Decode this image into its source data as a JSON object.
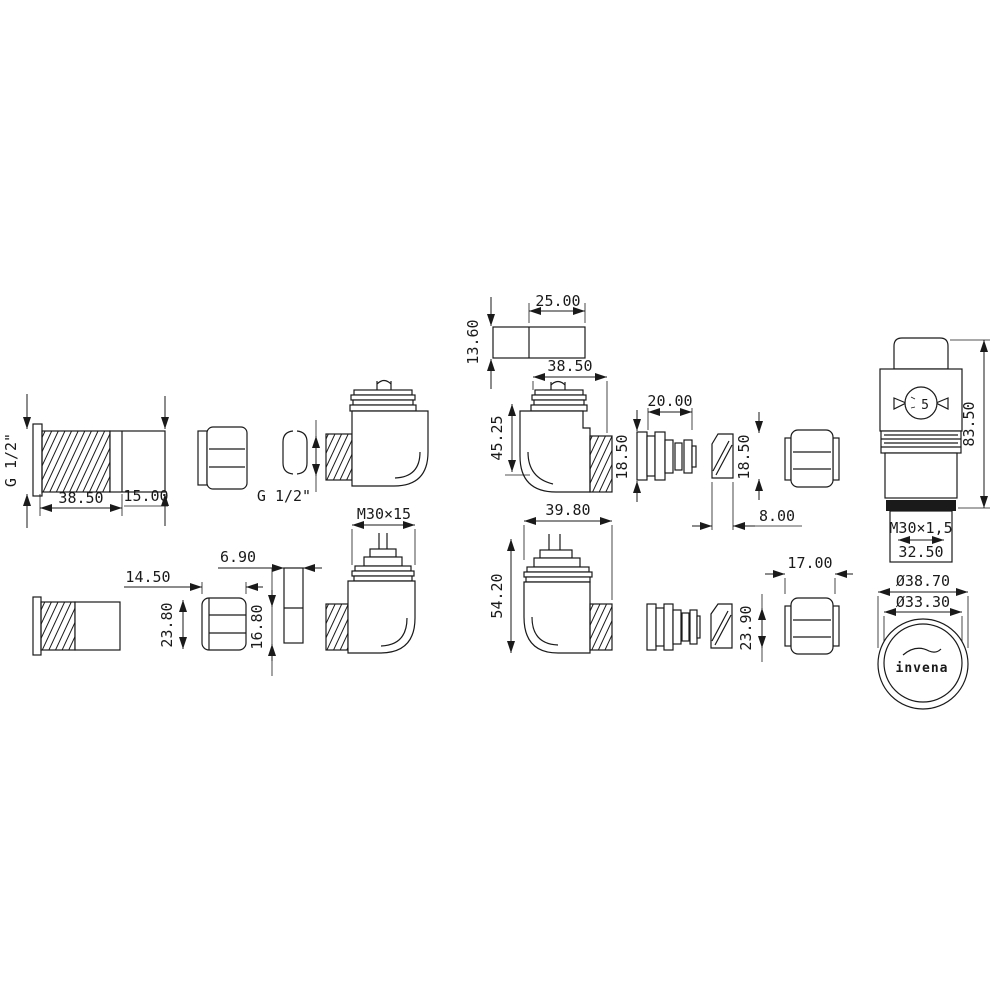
{
  "colors": {
    "background": "#ffffff",
    "line": "#1a1a1a"
  },
  "labels": {
    "g_half_tail": "G 1/2\"",
    "g_half_elbow": "G 1/2\"",
    "dim_38_50_tail": "38.50",
    "dim_15_00": "15.00",
    "dim_25_00": "25.00",
    "dim_13_60": "13.60",
    "dim_38_50_elbow": "38.50",
    "dim_45_25": "45.25",
    "dim_20_00": "20.00",
    "dim_18_50_barb": "18.50",
    "dim_18_50_olive": "18.50",
    "dim_8_00": "8.00",
    "dim_83_50": "83.50",
    "dial_number": "5",
    "thread_m30_head": "M30×1,5",
    "dim_32_50": "32.50",
    "dia_38_70": "Ø38.70",
    "dia_33_30": "Ø33.30",
    "brand": "invena",
    "thread_m30_valve": "M30×15",
    "dim_14_50": "14.50",
    "dim_23_80": "23.80",
    "dim_6_90": "6.90",
    "dim_16_80": "16.80",
    "dim_39_80": "39.80",
    "dim_54_20": "54.20",
    "dim_17_00": "17.00",
    "dim_23_90": "23.90"
  }
}
